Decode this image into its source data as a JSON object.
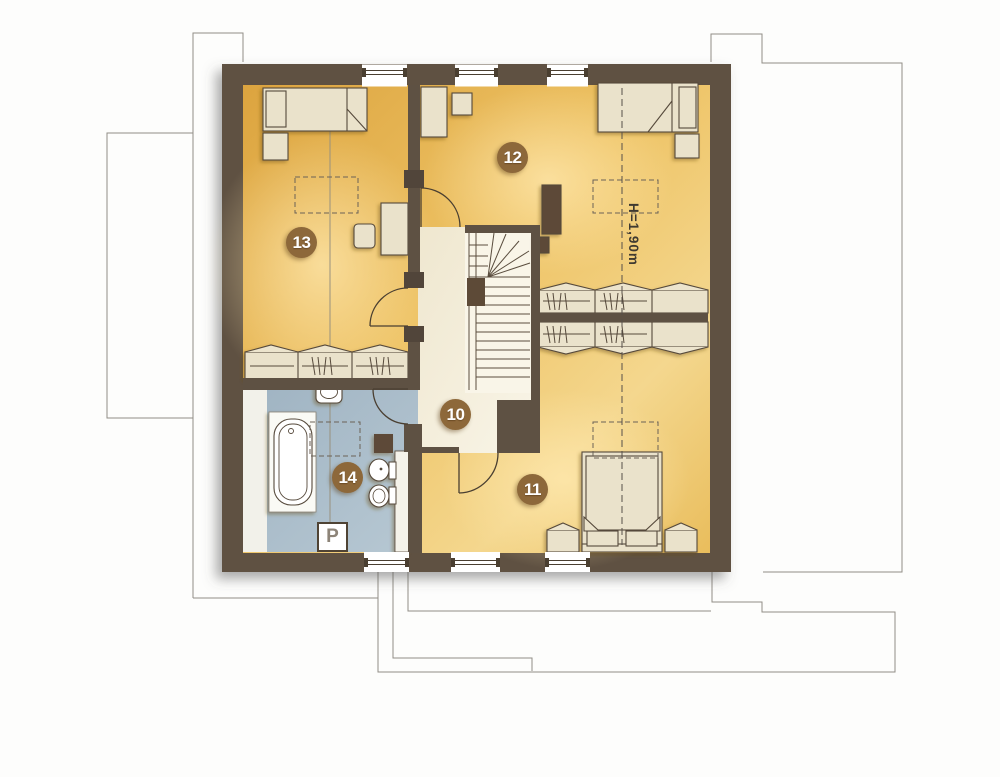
{
  "plan": {
    "room_labels": [
      {
        "id": "room-10",
        "number": "10"
      },
      {
        "id": "room-11",
        "number": "11"
      },
      {
        "id": "room-12",
        "number": "12"
      },
      {
        "id": "room-13",
        "number": "13"
      },
      {
        "id": "room-14",
        "number": "14"
      }
    ],
    "annotations": {
      "height_note": "H=1,90m",
      "washer_label": "P"
    },
    "colors": {
      "wall": "#5e5143",
      "room_floor": "#eec365",
      "room_floor_light": "#f6db9a",
      "room_floor_dark": "#dda23c",
      "hall_floor": "#f3edd9",
      "stairwell_floor": "#f9f5e8",
      "bathroom_floor": "#a7bbc8",
      "furniture_fill": "#eae2cb",
      "furniture_outline": "#55483a",
      "label_circle": "#8d683a",
      "label_text": "#ffffff",
      "construction_line": "#918d86",
      "dashed_line": "#57504a"
    }
  }
}
